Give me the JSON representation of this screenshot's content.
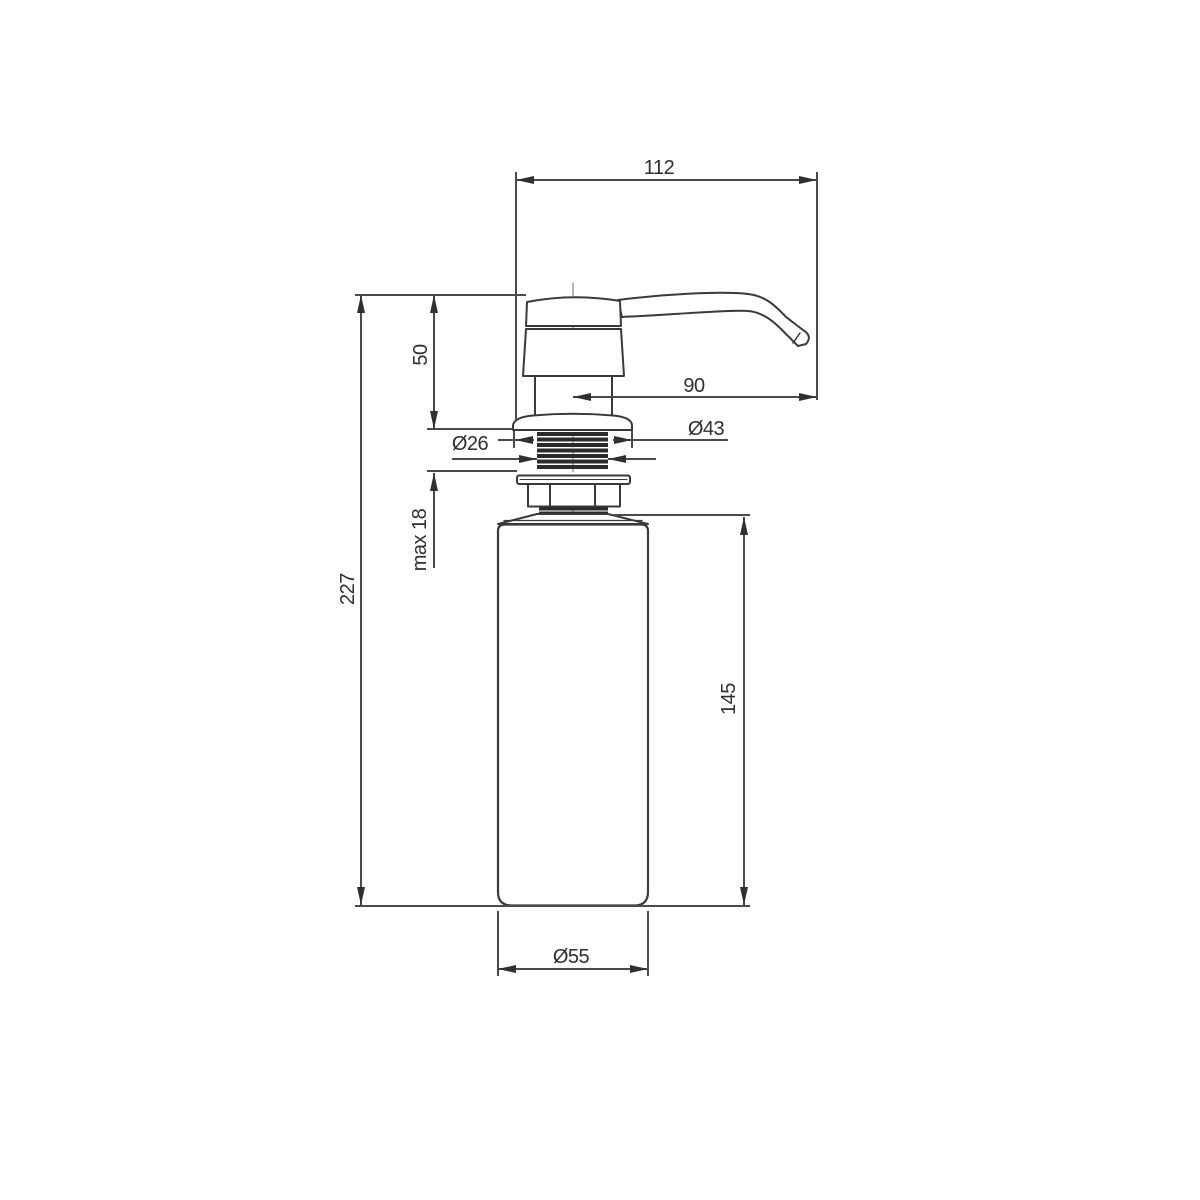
{
  "drawing": {
    "labels": {
      "overall_width": "112",
      "overall_height": "227",
      "head_height": "50",
      "spout_reach": "90",
      "flange_diameter": "Ø43",
      "thread_diameter": "Ø26",
      "max_panel_thickness": "max 18",
      "bottle_height": "145",
      "bottle_diameter": "Ø55"
    },
    "colors": {
      "outline": "#3a3a3a",
      "dimension_line": "#4a4a4a",
      "arrow": "#303030",
      "text": "#2e2e2e",
      "background": "#ffffff"
    }
  }
}
